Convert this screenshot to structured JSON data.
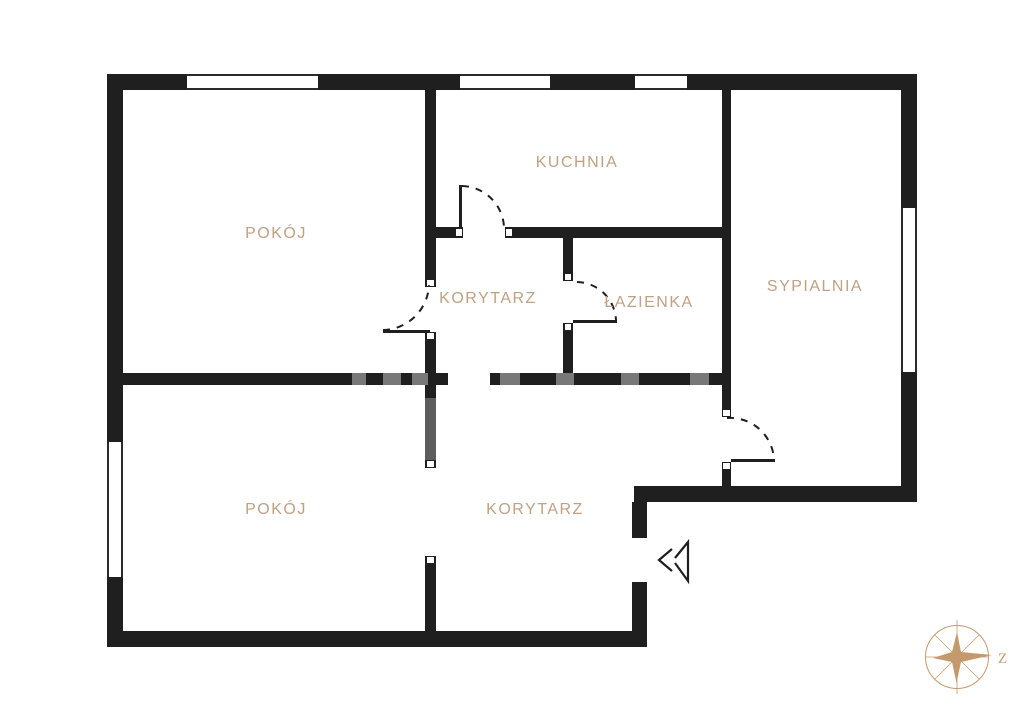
{
  "title": "Apartment floor plan",
  "rooms": {
    "pokoj_top": {
      "label": "POKÓJ"
    },
    "kuchnia": {
      "label": "KUCHNIA"
    },
    "korytarz_top": {
      "label": "KORYTARZ"
    },
    "lazienka": {
      "label": "ŁAZIENKA"
    },
    "sypialnia": {
      "label": "SYPIALNIA"
    },
    "pokoj_bottom": {
      "label": "POKÓJ"
    },
    "korytarz_bottom": {
      "label": "KORYTARZ"
    }
  },
  "compass": {
    "direction_label": "Z"
  },
  "features": {
    "window_count": 5,
    "interior_door_count": 4,
    "open_passage_count": 2,
    "entrance_marker": true
  },
  "colors": {
    "wall": "#1f1f1f",
    "label_text": "#bfa184",
    "compass": "#c49a6c",
    "background": "#ffffff"
  }
}
